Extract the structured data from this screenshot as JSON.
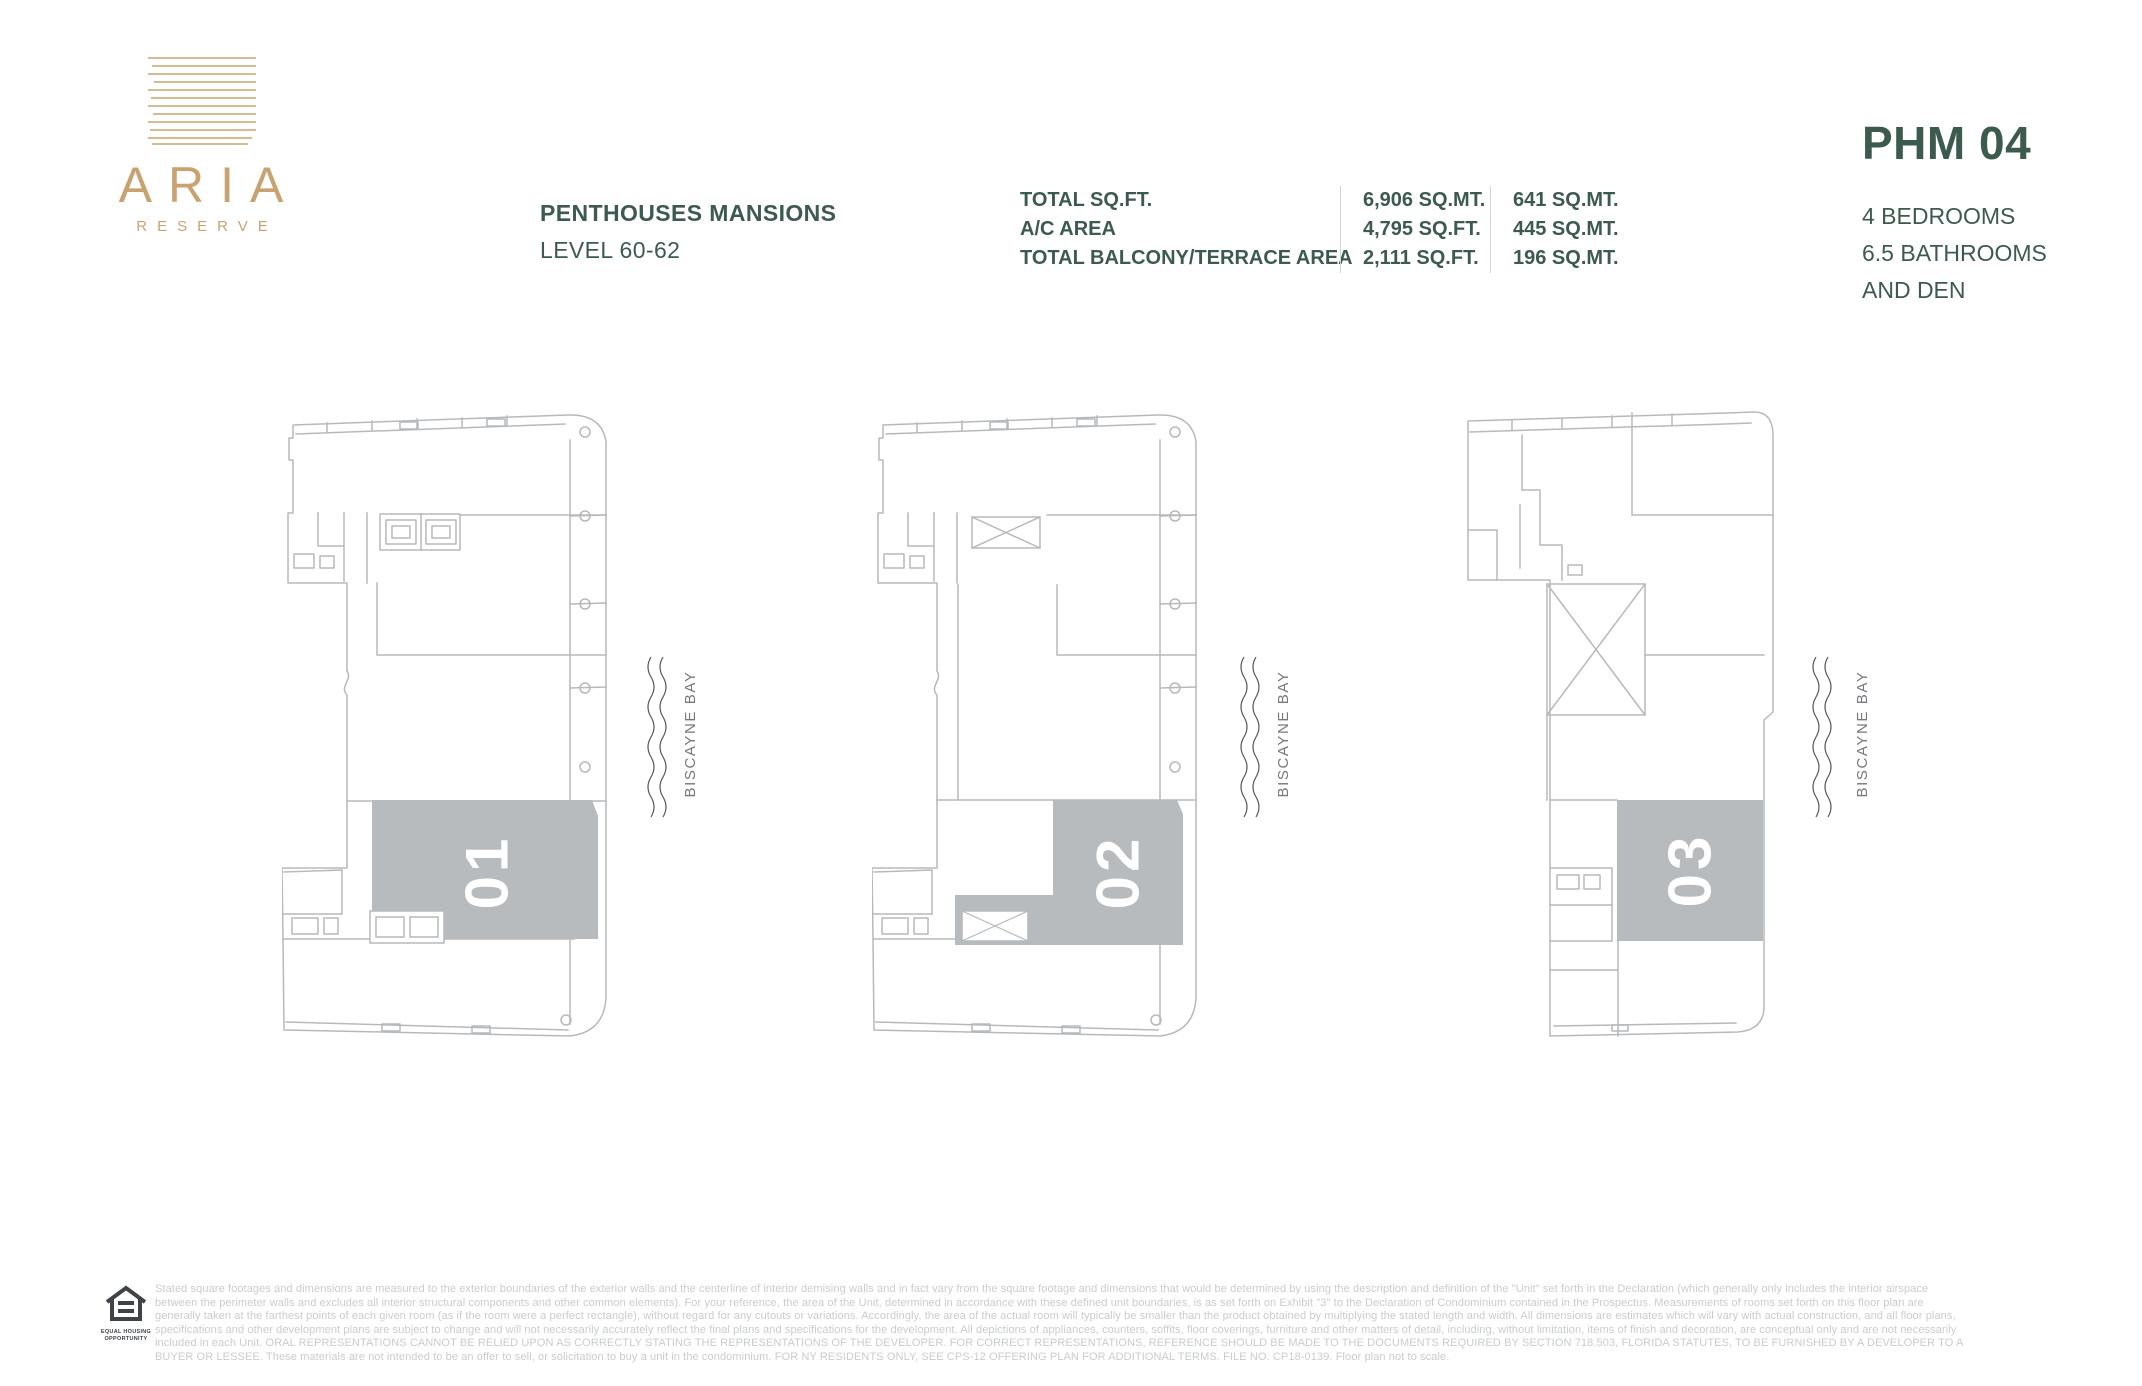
{
  "brand": {
    "name": "ARIA",
    "sub_name": "RESERVE"
  },
  "header": {
    "title": "PENTHOUSES MANSIONS",
    "subtitle": "LEVEL 60-62",
    "stats": [
      {
        "label": "TOTAL SQ.FT.",
        "value_ft": "6,906 SQ.MT.",
        "value_mt": "641 SQ.MT."
      },
      {
        "label": "A/C AREA",
        "value_ft": "4,795 SQ.FT.",
        "value_mt": "445 SQ.MT."
      },
      {
        "label": "TOTAL BALCONY/TERRACE AREA",
        "value_ft": "2,111 SQ.FT.",
        "value_mt": "196 SQ.MT."
      }
    ],
    "unit": {
      "code": "PHM 04",
      "features": [
        "4 BEDROOMS",
        "6.5 BATHROOMS",
        "AND DEN"
      ]
    }
  },
  "plans": [
    {
      "number": "01",
      "bay_label": "BISCAYNE BAY"
    },
    {
      "number": "02",
      "bay_label": "BISCAYNE BAY"
    },
    {
      "number": "03",
      "bay_label": "BISCAYNE BAY"
    }
  ],
  "footer": {
    "equal_housing_label": "EQUAL HOUSING OPPORTUNITY",
    "disclaimer": "Stated square footages and dimensions are measured to the exterior boundaries of the exterior walls and the centerline of interior demising walls and in fact vary from the square footage and dimensions that would be determined by using the description and definition of the \"Unit\" set forth in the Declaration (which generally only includes the interior airspace between the perimeter walls and excludes all interior structural components and other common elements). For your reference, the area of the Unit, determined in accordance with these defined unit boundaries, is as set forth on Exhibit \"3\" to the Declaration of Condominium contained in the Prospectus. Measurements of rooms set forth on this floor plan are generally taken at the farthest points of each given room (as if the room were a perfect rectangle), without regard for any cutouts or variations. Accordingly, the area of the actual room will typically be smaller than the product obtained by multiplying the stated length and width. All dimensions are estimates which will vary with actual construction, and all floor plans, specifications and other development plans are subject to change and will not necessarily accurately reflect the final plans and specifications for the development. All depictions of appliances, counters, soffits, floor coverings, furniture and other matters of detail, including, without limitation, items of finish and decoration, are conceptual only and are not necessarily included in each Unit. ORAL REPRESENTATIONS CANNOT BE RELIED UPON AS CORRECTLY STATING THE REPRESENTATIONS OF THE DEVELOPER. FOR CORRECT REPRESENTATIONS, REFERENCE SHOULD BE MADE TO THE DOCUMENTS REQUIRED BY SECTION 718.503, FLORIDA STATUTES, TO BE FURNISHED BY A DEVELOPER TO A BUYER OR LESSEE. These materials are not intended to be an offer to sell, or solicitation to buy a unit in the condominium. FOR NY RESIDENTS ONLY, SEE CPS-12 OFFERING PLAN FOR ADDITIONAL TERMS. FILE NO. CP18-0139. Floor plan not to scale."
  },
  "colors": {
    "brand_gold": "#c8a371",
    "accent_green": "#3d5a4e",
    "plan_line": "#b6b9bc",
    "unit_fill": "#b8bbbe"
  }
}
